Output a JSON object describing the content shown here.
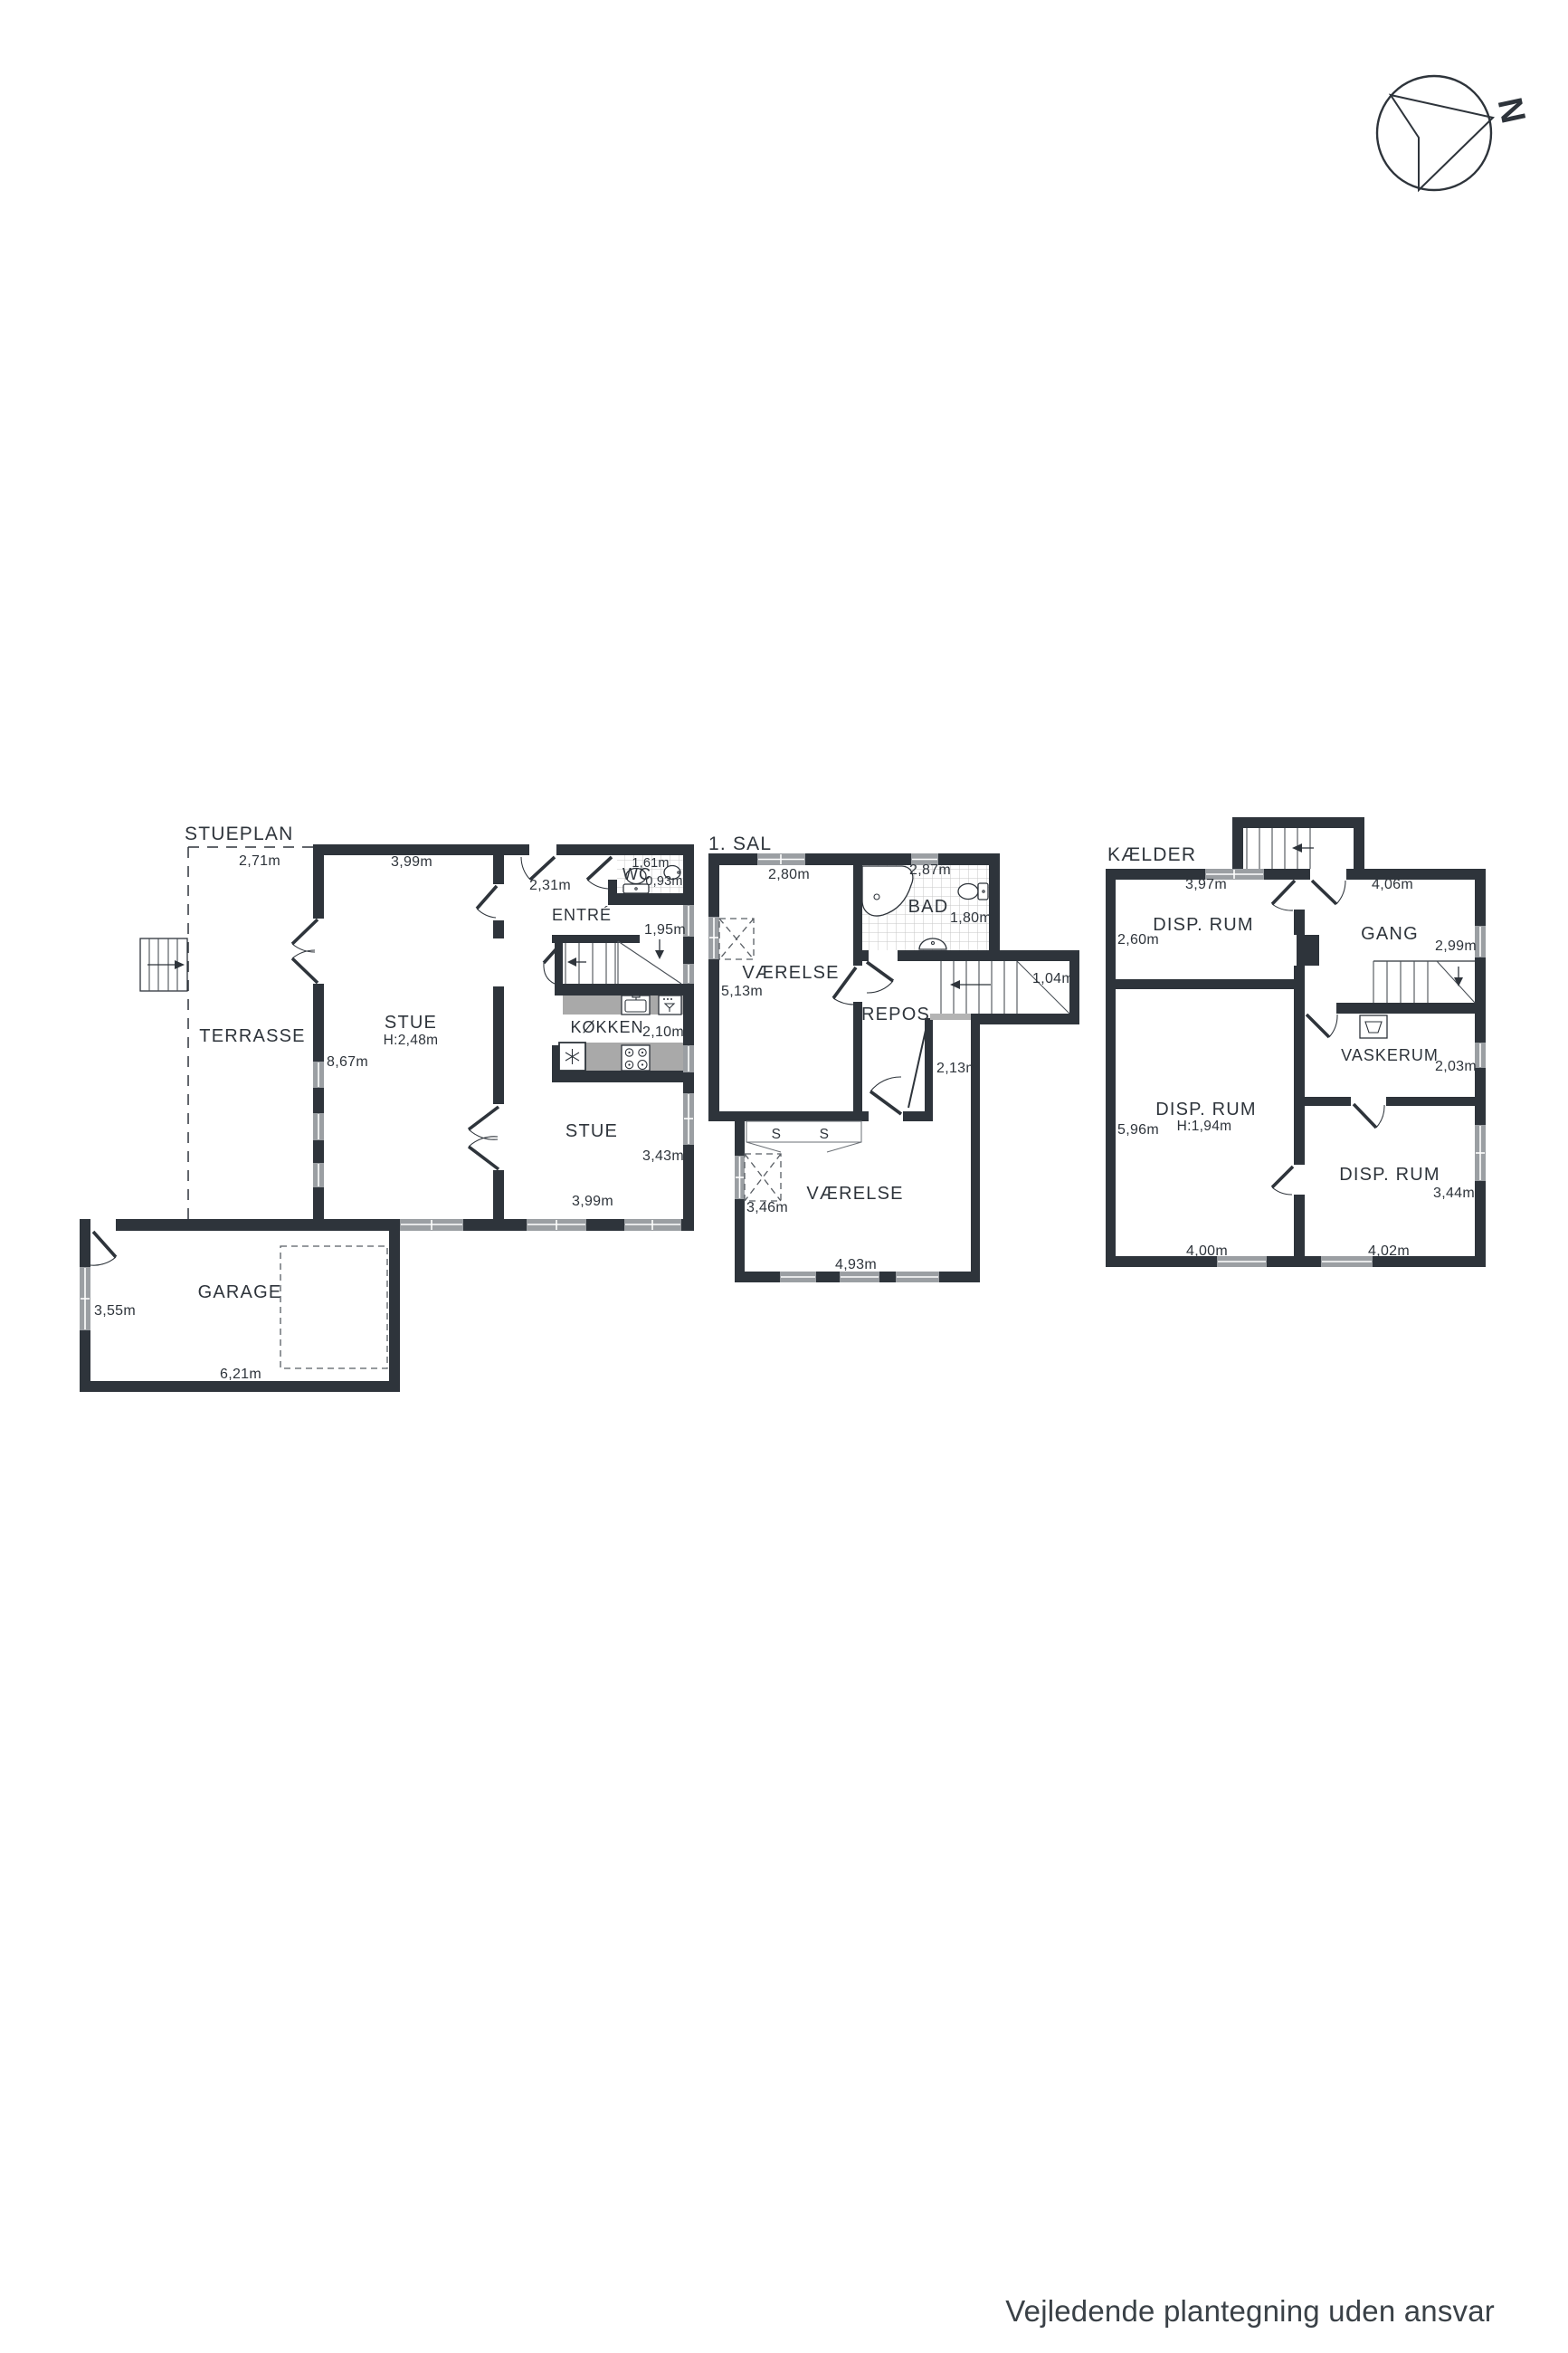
{
  "document": {
    "type": "floor-plan-drawing",
    "language": "da"
  },
  "colors": {
    "wall": "#2e343b",
    "text": "#2e343b",
    "window_gray": "#9b9fa3",
    "counter_gray": "#a9a9a9",
    "footer_text": "#3a4147",
    "background": "#ffffff"
  },
  "compass": {
    "north_label": "N"
  },
  "footer": {
    "disclaimer": "Vejledende plantegning uden ansvar"
  },
  "floors": {
    "ground": {
      "title": "STUEPLAN",
      "terrasse": {
        "name": "TERRASSE",
        "width": "2,71m"
      },
      "stue": {
        "name": "STUE",
        "ceiling_height": "H:2,48m",
        "top_width": "3,99m",
        "side_height": "8,67m"
      },
      "entre": {
        "name": "ENTRÉ",
        "width": "2,31m",
        "right_depth": "1,95m"
      },
      "wc": {
        "name": "WC",
        "width": "1,61m",
        "depth": "0,93m"
      },
      "kokken": {
        "name": "KØKKEN",
        "depth": "2,10m"
      },
      "stue2": {
        "name": "STUE",
        "right_height": "3,43m",
        "bottom_width": "3,99m"
      },
      "garage": {
        "name": "GARAGE",
        "side_height": "3,55m",
        "bottom_width": "6,21m"
      }
    },
    "first": {
      "title": "1. SAL",
      "vaerelse_nw": {
        "name": "VÆRELSE",
        "top_width": "2,80m",
        "side_height": "5,13m"
      },
      "bad": {
        "name": "BAD",
        "top_width": "2,87m",
        "side_height": "1,80m"
      },
      "repos": {
        "name": "REPOS",
        "stair_width": "1,04m",
        "niche_width": "2,13m"
      },
      "vaerelse_s": {
        "name": "VÆRELSE",
        "side_height": "3,46m",
        "bottom_width": "4,93m",
        "closet_label_1": "S",
        "closet_label_2": "S"
      }
    },
    "basement": {
      "title": "KÆLDER",
      "disp_nw": {
        "name": "DISP. RUM",
        "top_width": "3,97m",
        "side_height": "2,60m"
      },
      "gang": {
        "name": "GANG",
        "top_width": "4,06m",
        "side_height": "2,99m"
      },
      "disp_w": {
        "name": "DISP. RUM",
        "ceiling_height": "H:1,94m",
        "side_height": "5,96m",
        "bottom_width": "4,00m"
      },
      "vaskerum": {
        "name": "VASKERUM",
        "side_height": "2,03m"
      },
      "disp_se": {
        "name": "DISP. RUM",
        "side_height": "3,44m",
        "bottom_width": "4,02m"
      }
    }
  }
}
